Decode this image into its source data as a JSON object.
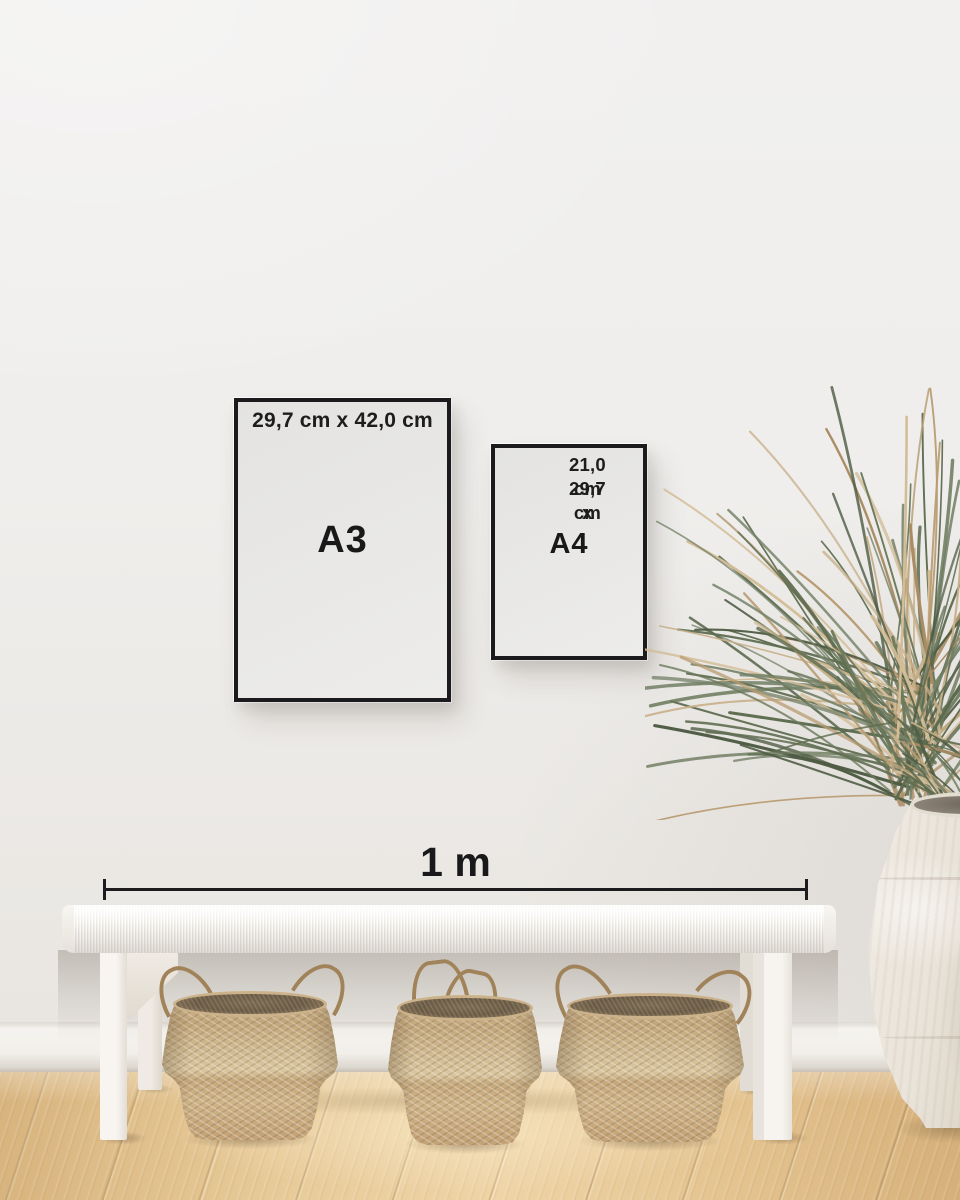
{
  "scale_bar": {
    "label": "1 m"
  },
  "frames": {
    "a3": {
      "label": "A3",
      "dimensions": "29,7 cm x 42,0 cm"
    },
    "a4": {
      "label": "A4",
      "dimensions_line1": "21,0 cm x",
      "dimensions_line2": "29,7 cm"
    }
  },
  "colors": {
    "wall": "#efeeec",
    "baseboard": "#f2efea",
    "floor_wood": "#e3c28e",
    "frame_border": "#1b1b1e",
    "annotation_text": "#1a1a1a",
    "scale_line": "#1c1c1e",
    "bench_white": "#f5f2ed",
    "basket_seagrass": "#c9ad82",
    "vase_ceramic": "#e7e1d7",
    "plant_green": "#62704f",
    "plant_dry": "#bda077"
  },
  "scene": {
    "objects": [
      "black poster frame A3 on wall",
      "black poster frame A4 on wall",
      "white woven bench",
      "three seagrass belly baskets under bench",
      "white ceramic floor vase",
      "dried palm plant",
      "wood floor",
      "white wall with baseboard"
    ]
  }
}
